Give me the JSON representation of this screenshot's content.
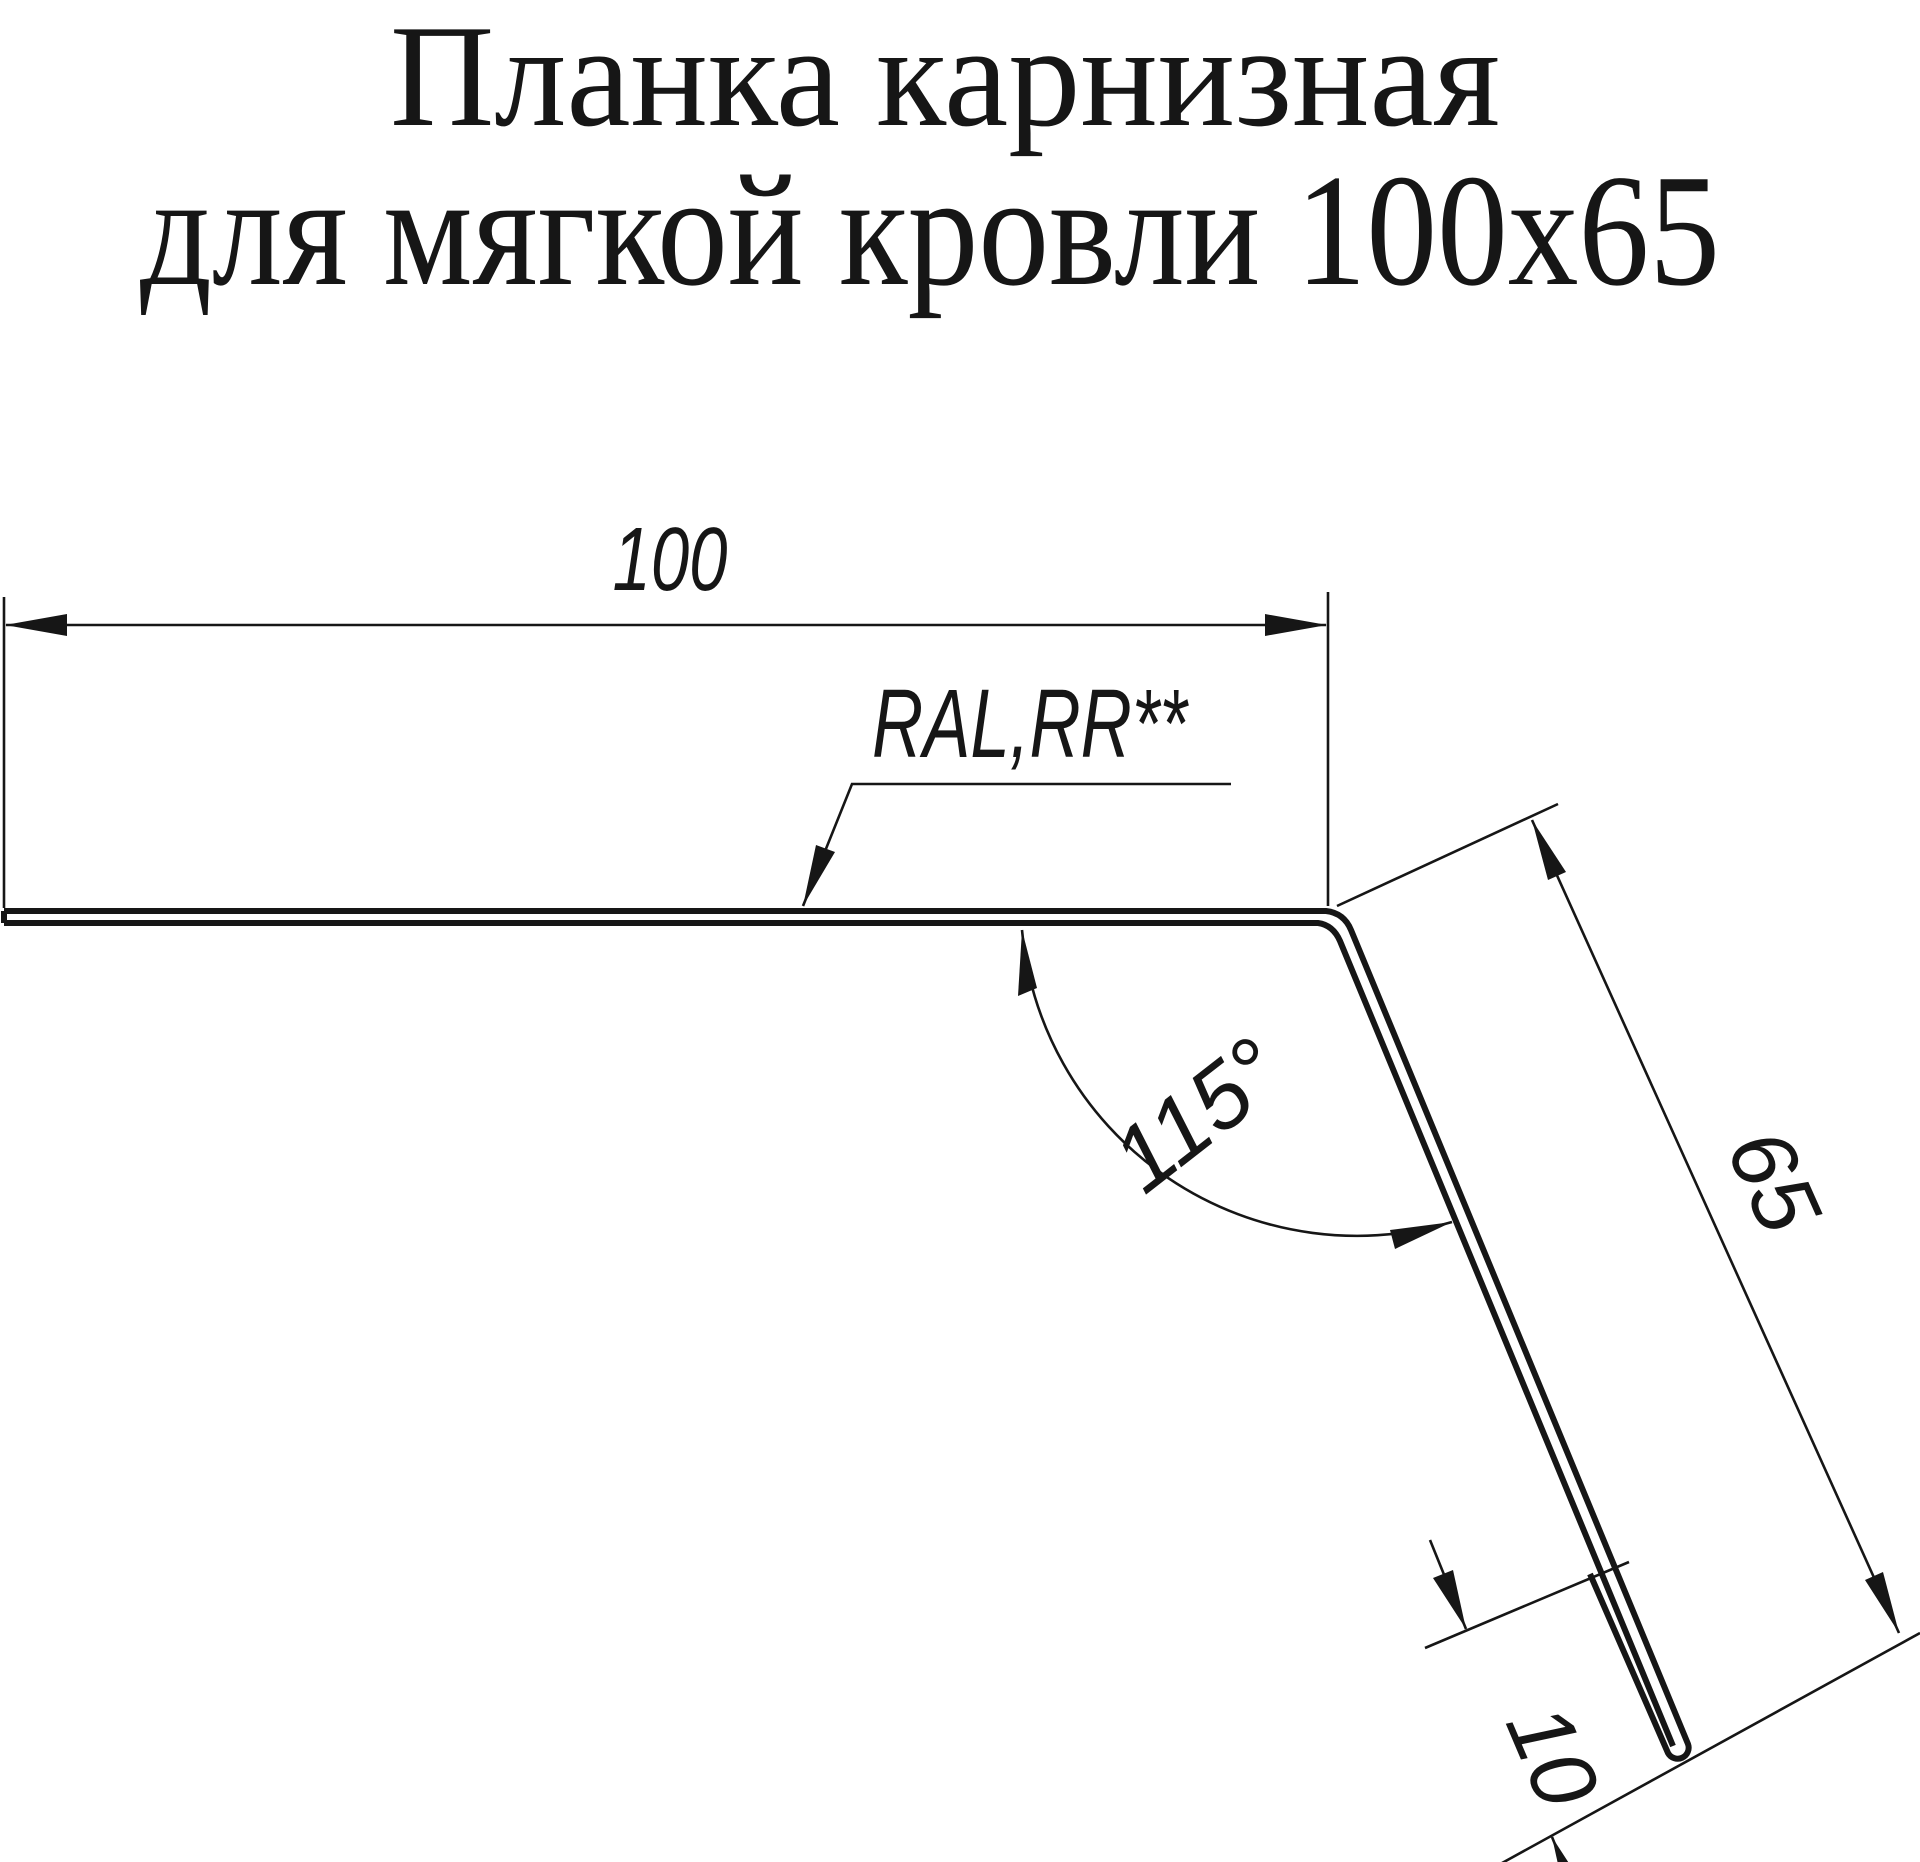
{
  "title": {
    "line1": "Планка карнизная",
    "line2": "для мягкой кровли 100х65"
  },
  "drawing": {
    "part": "eaves-strip-cross-section",
    "dimensions": {
      "top_flange_width": "100",
      "side_drop_length": "65",
      "bottom_hem_length": "10",
      "bend_angle": "115°"
    },
    "coating_note": "RAL,RR**"
  },
  "colors": {
    "ink": "#161616",
    "background": "#ffffff"
  }
}
